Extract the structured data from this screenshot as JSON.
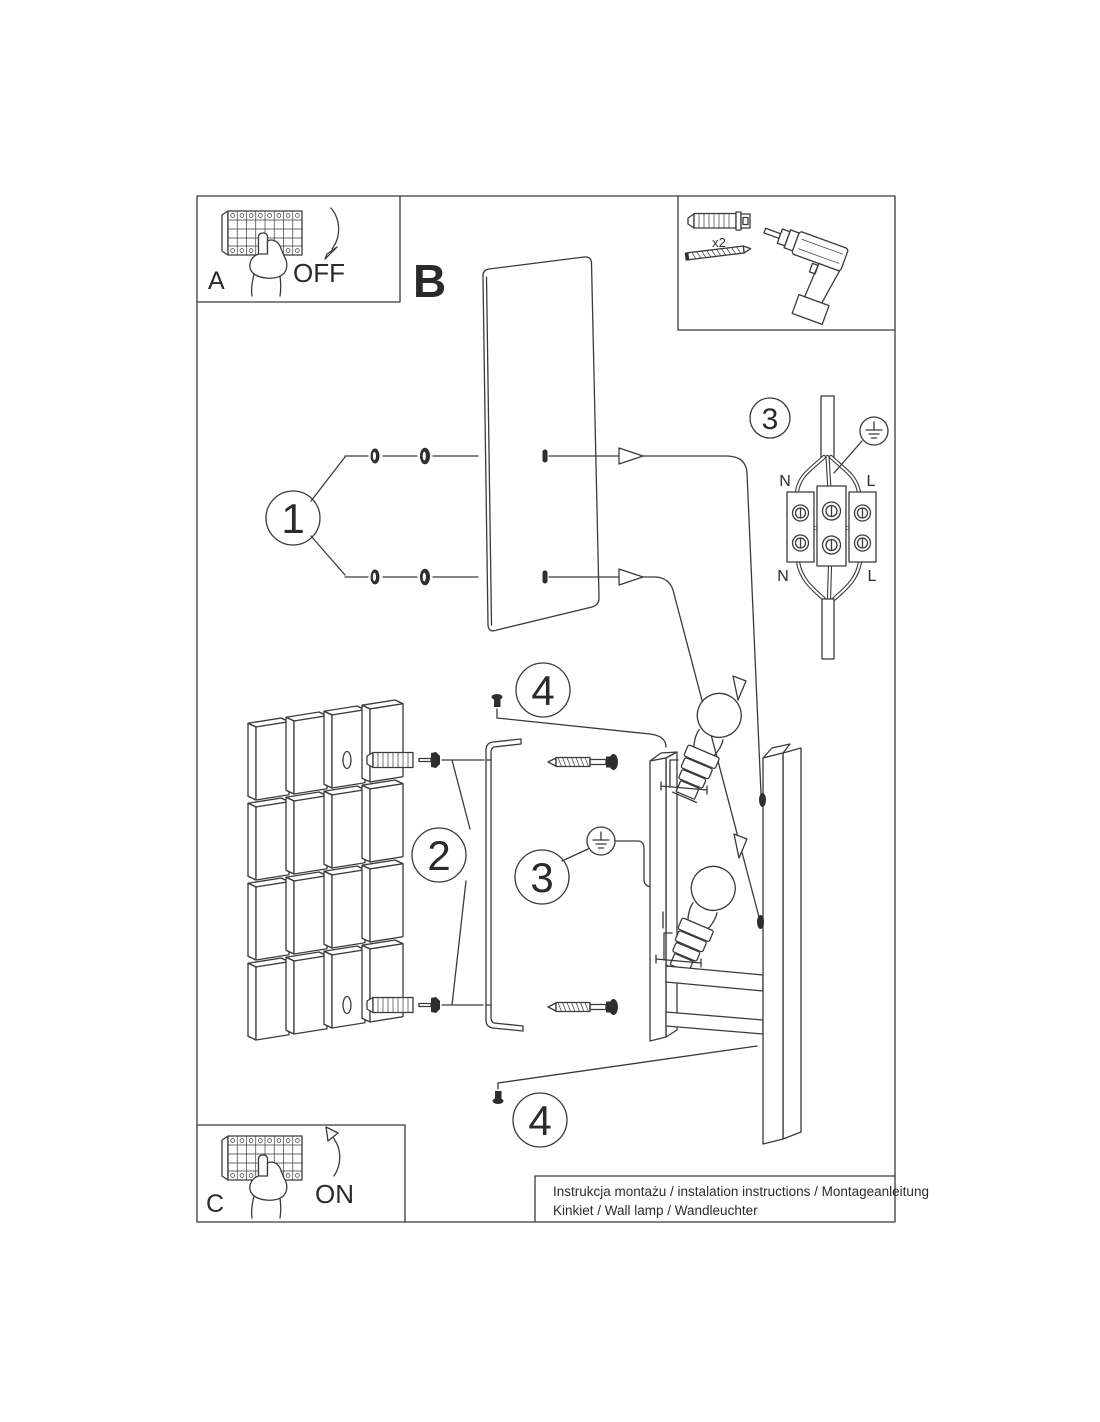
{
  "sheet": {
    "caption_line1": "Instrukcja montażu / instalation instructions / Montageanleitung",
    "caption_line2": "Kinkiet / Wall lamp / Wandleuchter"
  },
  "sections": {
    "a": "A",
    "b": "B",
    "c": "C"
  },
  "switch_states": {
    "off": "OFF",
    "on": "ON"
  },
  "steps": {
    "s1": "1",
    "s2": "2",
    "s3": "3",
    "s4": "4"
  },
  "tools": {
    "anchor_count": "x2"
  },
  "wiring": {
    "neutral": "N",
    "live": "L"
  },
  "colors": {
    "line": "#3a3a3a",
    "text": "#2b2b2b",
    "background": "#ffffff"
  }
}
